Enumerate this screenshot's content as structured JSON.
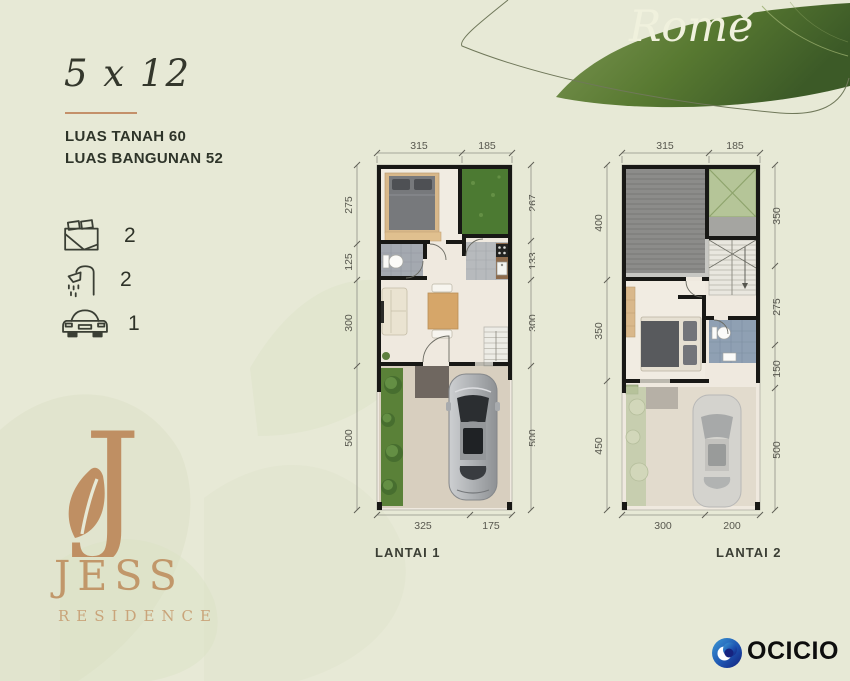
{
  "type_label": "Rome",
  "size_label": "5 x 12",
  "specs": [
    "LUAS TANAH 60",
    "LUAS BANGUNAN 52"
  ],
  "features": [
    {
      "icon": "bed-icon",
      "count": "2"
    },
    {
      "icon": "shower-icon",
      "count": "2"
    },
    {
      "icon": "car-icon",
      "count": "1"
    }
  ],
  "plans": [
    {
      "label": "LANTAI 1",
      "dims_top": [
        "315",
        "185"
      ],
      "dims_left": [
        "275",
        "125",
        "300",
        "500"
      ],
      "dims_right": [
        "267",
        "133",
        "300",
        "500"
      ],
      "dims_bottom": [
        "325",
        "175"
      ]
    },
    {
      "label": "LANTAI 2",
      "dims_top": [
        "315",
        "185"
      ],
      "dims_left": [
        "400",
        "350",
        "450"
      ],
      "dims_right": [
        "350",
        "275",
        "150",
        "500"
      ],
      "dims_bottom": [
        "300",
        "200"
      ]
    }
  ],
  "brand": {
    "initial": "J",
    "name": "JESS",
    "subtitle": "RESIDENCE"
  },
  "footer": {
    "developer": "OCICIO"
  },
  "colors": {
    "background": "#e7e9d6",
    "leaf_green": "#55762f",
    "accent_tan": "#c1976a",
    "wall_black": "#181815",
    "logo_blue": "#16237f"
  }
}
